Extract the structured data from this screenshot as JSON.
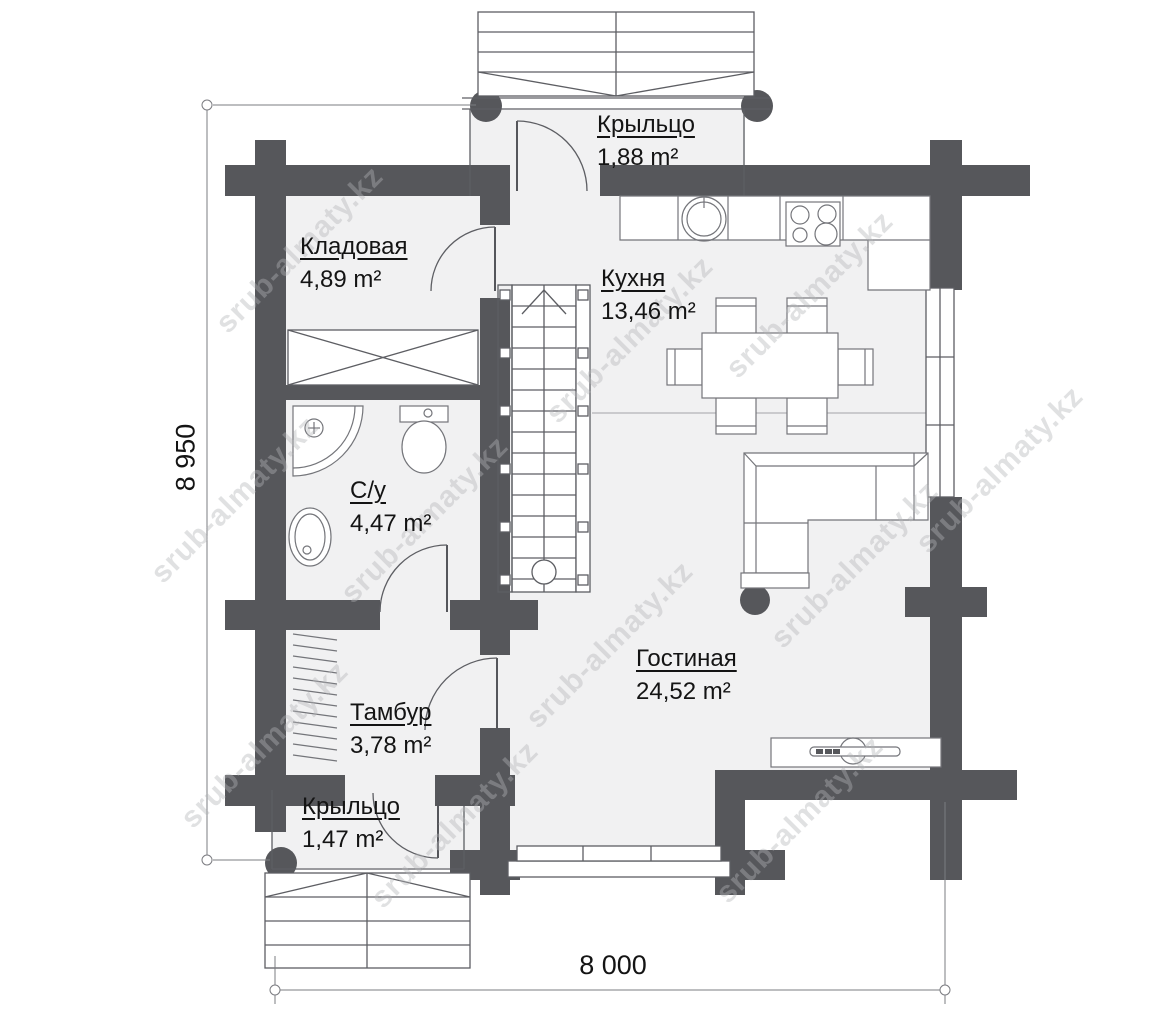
{
  "watermark": {
    "text": "srub-almaty.kz"
  },
  "rooms": [
    {
      "name": "Крыльцо",
      "area": "1,88 m²"
    },
    {
      "name": "Кладовая",
      "area": "4,89 m²"
    },
    {
      "name": "Кухня",
      "area": "13,46 m²"
    },
    {
      "name": "С/у",
      "area": "4,47 m²"
    },
    {
      "name": "Тамбур",
      "area": "3,78 m²"
    },
    {
      "name": "Гостиная",
      "area": "24,52 m²"
    },
    {
      "name": "Крыльцо",
      "area": "1,47 m²"
    }
  ],
  "dimensions": {
    "height_mm": "8 950",
    "width_mm": "8 000"
  },
  "colors": {
    "wall": "#56575b",
    "room_fill": "#f1f1f2",
    "watermark": "#b4b5b8",
    "line": "#5d5e63"
  }
}
